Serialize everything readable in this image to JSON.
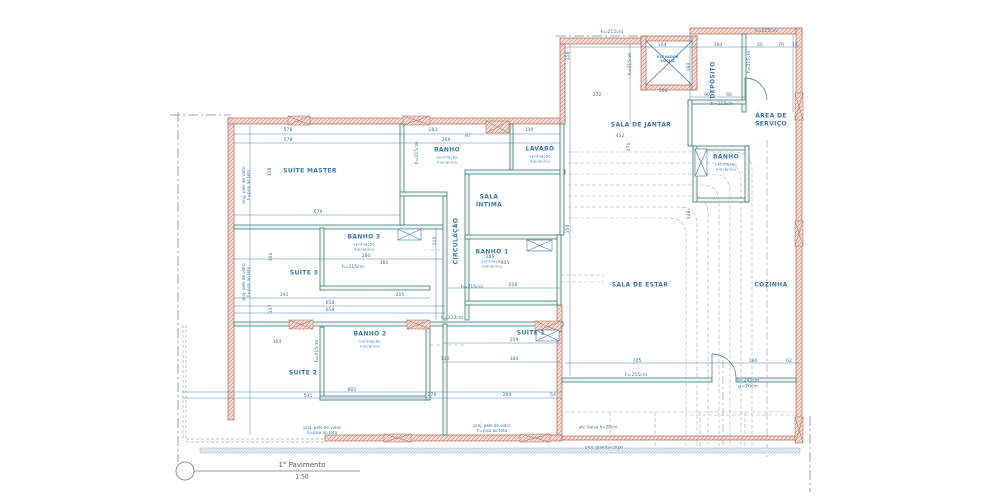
{
  "title": {
    "name": "1° Pavimento",
    "scale": "1:50"
  },
  "colors": {
    "dimension_blue": "#3a78b5",
    "wall_teal": "#417d72",
    "wall_hatch_fill": "#f5ded5",
    "wall_hatch_line": "#c88d7d",
    "wall_outline_red": "#b06a5a",
    "dashed_gray": "#9fb0bc",
    "axis_red": "#e09090",
    "boundary_gray": "#8a8a8a"
  },
  "rooms": [
    {
      "label": "SUÍTE MASTER",
      "x": 310,
      "y": 171
    },
    {
      "label": "BANHO",
      "sub": "ventilação\nmecânica",
      "x": 447,
      "y": 150,
      "suboff": 10
    },
    {
      "label": "LAVABO",
      "sub": "ventilação\nmecânica",
      "x": 540,
      "y": 149,
      "suboff": 10
    },
    {
      "label": "SALA DE JANTAR",
      "x": 641,
      "y": 125
    },
    {
      "label": "DEPÓSITO",
      "x": 713,
      "y": 80,
      "r": 1
    },
    {
      "label": "ÁREA DE\nSERVIÇO",
      "x": 771,
      "y": 120
    },
    {
      "label": "BANHO",
      "sub": "ventilação\nmecânica",
      "x": 726,
      "y": 157,
      "suboff": 10
    },
    {
      "label": "SALA\nÍNTIMA",
      "x": 489,
      "y": 201
    },
    {
      "label": "CIRCULAÇÃO",
      "x": 456,
      "y": 241,
      "r": 1
    },
    {
      "label": "BANHO 3",
      "sub": "ventilação\nmecânica",
      "x": 364,
      "y": 237,
      "suboff": 10
    },
    {
      "label": "SUÍTE 3",
      "x": 304,
      "y": 273
    },
    {
      "label": "BANHO 1",
      "sub": "ventilação\nmecânica",
      "x": 492,
      "y": 252,
      "suboff": 12
    },
    {
      "label": "SALA DE ESTAR",
      "x": 640,
      "y": 285
    },
    {
      "label": "COZINHA",
      "x": 771,
      "y": 285
    },
    {
      "label": "BANHO 2",
      "sub": "ventilação\nmecânica",
      "x": 370,
      "y": 334,
      "suboff": 10
    },
    {
      "label": "SUÍTE 2",
      "x": 303,
      "y": 373
    },
    {
      "label": "SUÍTE 1",
      "x": 531,
      "y": 333
    },
    {
      "label": "ELEVADOR\nSOCIAL",
      "x": 668,
      "y": 59,
      "size": 3.2
    }
  ],
  "annotations": [
    {
      "t": "proj. pele de vidro\nh=piso ao teto",
      "x": 246,
      "y": 185,
      "r": 1
    },
    {
      "t": "proj. pele de vidro\nh=piso ao teto",
      "x": 246,
      "y": 282,
      "r": 1
    },
    {
      "t": "proj. pele de vidro\nh=piso ao teto",
      "x": 322,
      "y": 430
    },
    {
      "t": "proj. pele de vidro\nh=piso ao teto",
      "x": 492,
      "y": 428
    },
    {
      "t": "alv. baixa h=20cm",
      "x": 598,
      "y": 427
    },
    {
      "t": "proj. guarda-corpo",
      "x": 604,
      "y": 447
    }
  ],
  "dimensions": [
    {
      "t": "578",
      "x": 288,
      "y": 131
    },
    {
      "t": "578",
      "x": 288,
      "y": 141
    },
    {
      "t": "283",
      "x": 433,
      "y": 131
    },
    {
      "t": "269",
      "x": 446,
      "y": 141
    },
    {
      "t": "87",
      "x": 468,
      "y": 137
    },
    {
      "t": "139",
      "x": 529,
      "y": 131
    },
    {
      "t": "452",
      "x": 620,
      "y": 137
    },
    {
      "t": "338",
      "x": 271,
      "y": 172,
      "r": 1
    },
    {
      "t": "679",
      "x": 318,
      "y": 213
    },
    {
      "t": "171",
      "x": 630,
      "y": 147,
      "r": 1
    },
    {
      "t": "158",
      "x": 569,
      "y": 56,
      "r": 1
    },
    {
      "t": "104",
      "x": 662,
      "y": 46
    },
    {
      "t": "194",
      "x": 718,
      "y": 46
    },
    {
      "t": "66",
      "x": 760,
      "y": 46
    },
    {
      "t": "79",
      "x": 781,
      "y": 46
    },
    {
      "t": "14",
      "x": 795,
      "y": 46
    },
    {
      "t": "166",
      "x": 663,
      "y": 92
    },
    {
      "t": "272",
      "x": 597,
      "y": 96
    },
    {
      "t": "90",
      "x": 707,
      "y": 96
    },
    {
      "t": "66",
      "x": 729,
      "y": 96
    },
    {
      "t": "180",
      "x": 690,
      "y": 67,
      "r": 1
    },
    {
      "t": "h=215cm",
      "x": 612,
      "y": 33
    },
    {
      "t": "h=215cm",
      "x": 766,
      "y": 32
    },
    {
      "t": "h=215cm",
      "x": 631,
      "y": 64,
      "r": 1
    },
    {
      "t": "h=215cm",
      "x": 750,
      "y": 62,
      "r": 1
    },
    {
      "t": "h=215cm",
      "x": 722,
      "y": 105
    },
    {
      "t": "h=215cm",
      "x": 418,
      "y": 153,
      "r": 1
    },
    {
      "t": "h=215cm",
      "x": 353,
      "y": 268
    },
    {
      "t": "h=215cm",
      "x": 472,
      "y": 288
    },
    {
      "t": "h=233cm",
      "x": 452,
      "y": 319
    },
    {
      "t": "h=215cm",
      "x": 318,
      "y": 351,
      "r": 1
    },
    {
      "t": "h=255cm",
      "x": 636,
      "y": 376
    },
    {
      "t": "h=245cm\np=20cm",
      "x": 748,
      "y": 384
    },
    {
      "t": "280",
      "x": 366,
      "y": 257
    },
    {
      "t": "381",
      "x": 384,
      "y": 264
    },
    {
      "t": "364",
      "x": 272,
      "y": 257,
      "r": 1
    },
    {
      "t": "337",
      "x": 272,
      "y": 309,
      "r": 1
    },
    {
      "t": "342",
      "x": 284,
      "y": 296
    },
    {
      "t": "658",
      "x": 330,
      "y": 304
    },
    {
      "t": "658",
      "x": 330,
      "y": 311
    },
    {
      "t": "205",
      "x": 400,
      "y": 296
    },
    {
      "t": "110",
      "x": 436,
      "y": 241,
      "r": 1
    },
    {
      "t": "286",
      "x": 490,
      "y": 258
    },
    {
      "t": "305",
      "x": 505,
      "y": 264
    },
    {
      "t": "206",
      "x": 513,
      "y": 286
    },
    {
      "t": "209",
      "x": 514,
      "y": 341
    },
    {
      "t": "384",
      "x": 514,
      "y": 360
    },
    {
      "t": "130",
      "x": 445,
      "y": 360
    },
    {
      "t": "264",
      "x": 507,
      "y": 396
    },
    {
      "t": "54",
      "x": 553,
      "y": 396
    },
    {
      "t": "364",
      "x": 277,
      "y": 343
    },
    {
      "t": "531",
      "x": 308,
      "y": 397
    },
    {
      "t": "801",
      "x": 352,
      "y": 391
    },
    {
      "t": "270",
      "x": 432,
      "y": 396
    },
    {
      "t": "705",
      "x": 637,
      "y": 362
    },
    {
      "t": "180",
      "x": 753,
      "y": 362
    },
    {
      "t": "62",
      "x": 789,
      "y": 362
    },
    {
      "t": "328",
      "x": 690,
      "y": 215,
      "r": 1
    },
    {
      "t": "150",
      "x": 569,
      "y": 229,
      "r": 1
    }
  ]
}
